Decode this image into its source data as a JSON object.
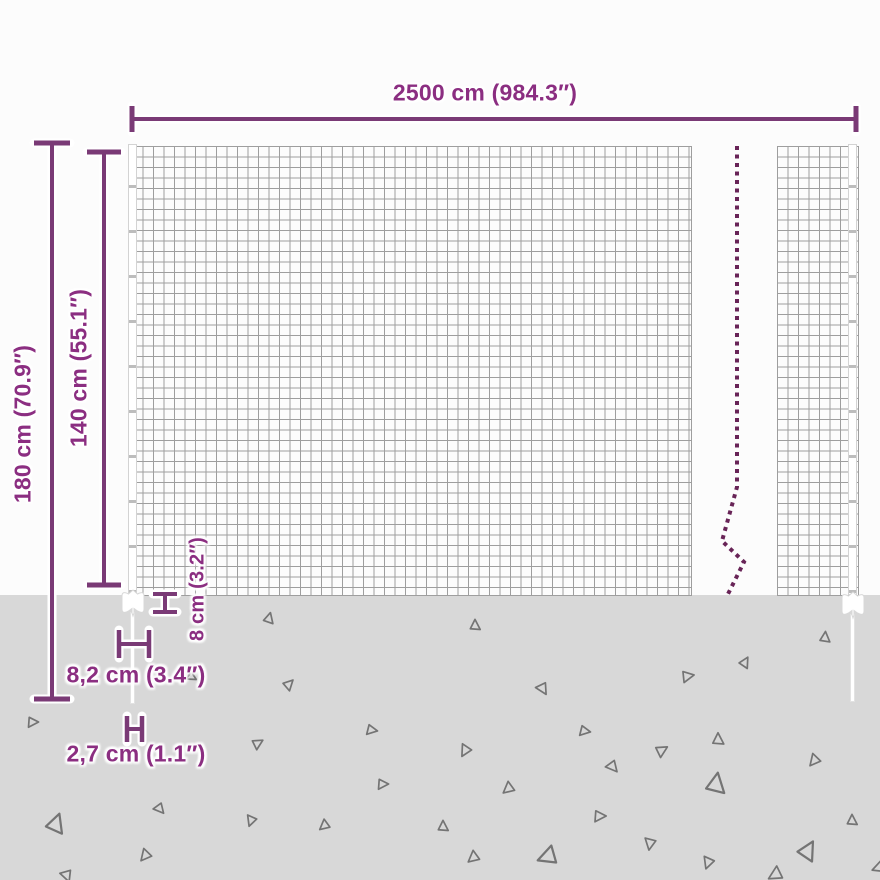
{
  "labels": {
    "width": "2500 cm (984.3″)",
    "total_height": "180 cm (70.9″)",
    "mesh_height": "140 cm (55.1″)",
    "underground_depth": "8 cm (3.2″)",
    "anchor_width": "8,2 cm (3.4″)",
    "post_diameter": "2,7 cm (1.1″)"
  },
  "colors": {
    "accent_text": "#8b2e81",
    "dimension_line": "#7a3a76",
    "break_line": "#682457",
    "ground": "#d8d8d8",
    "mesh_line": "#9e9e9e",
    "gravel": "#747474"
  },
  "ground": {
    "triangles": [
      {
        "x": 269,
        "y": 618,
        "s": 9,
        "r": 15
      },
      {
        "x": 475,
        "y": 625,
        "s": 9,
        "r": 0
      },
      {
        "x": 825,
        "y": 637,
        "s": 9,
        "r": 5
      },
      {
        "x": 289,
        "y": 684,
        "s": 9,
        "r": 45
      },
      {
        "x": 745,
        "y": 662,
        "s": 9,
        "r": 30
      },
      {
        "x": 688,
        "y": 676,
        "s": 10,
        "r": 80
      },
      {
        "x": 543,
        "y": 689,
        "s": 10,
        "r": 150
      },
      {
        "x": 33,
        "y": 722,
        "s": 9,
        "r": 90
      },
      {
        "x": 372,
        "y": 730,
        "s": 9,
        "r": 100
      },
      {
        "x": 585,
        "y": 731,
        "s": 9,
        "r": 100
      },
      {
        "x": 718,
        "y": 739,
        "s": 10,
        "r": 0
      },
      {
        "x": 465,
        "y": 751,
        "s": 10,
        "r": 210
      },
      {
        "x": 662,
        "y": 750,
        "s": 10,
        "r": 60
      },
      {
        "x": 258,
        "y": 743,
        "s": 9,
        "r": 60
      },
      {
        "x": 814,
        "y": 761,
        "s": 10,
        "r": 220
      },
      {
        "x": 613,
        "y": 767,
        "s": 10,
        "r": 140
      },
      {
        "x": 383,
        "y": 784,
        "s": 9,
        "r": 90
      },
      {
        "x": 716,
        "y": 783,
        "s": 17,
        "r": 10
      },
      {
        "x": 508,
        "y": 789,
        "s": 10,
        "r": 230
      },
      {
        "x": 56,
        "y": 823,
        "s": 16,
        "r": 20
      },
      {
        "x": 160,
        "y": 809,
        "s": 9,
        "r": 140
      },
      {
        "x": 852,
        "y": 820,
        "s": 9,
        "r": 0
      },
      {
        "x": 600,
        "y": 816,
        "s": 10,
        "r": 90
      },
      {
        "x": 443,
        "y": 826,
        "s": 9,
        "r": 0
      },
      {
        "x": 251,
        "y": 821,
        "s": 9,
        "r": 200
      },
      {
        "x": 324,
        "y": 826,
        "s": 9,
        "r": 230
      },
      {
        "x": 650,
        "y": 844,
        "s": 10,
        "r": 190
      },
      {
        "x": 808,
        "y": 850,
        "s": 16,
        "r": 30
      },
      {
        "x": 145,
        "y": 856,
        "s": 10,
        "r": 220
      },
      {
        "x": 473,
        "y": 858,
        "s": 10,
        "r": 230
      },
      {
        "x": 547,
        "y": 857,
        "s": 16,
        "r": 250
      },
      {
        "x": 708,
        "y": 863,
        "s": 10,
        "r": 200
      },
      {
        "x": 192,
        "y": 677,
        "s": 8,
        "r": 120
      },
      {
        "x": 67,
        "y": 876,
        "s": 10,
        "r": 160
      },
      {
        "x": 775,
        "y": 875,
        "s": 12,
        "r": 240
      },
      {
        "x": 878,
        "y": 868,
        "s": 10,
        "r": 250
      }
    ]
  }
}
